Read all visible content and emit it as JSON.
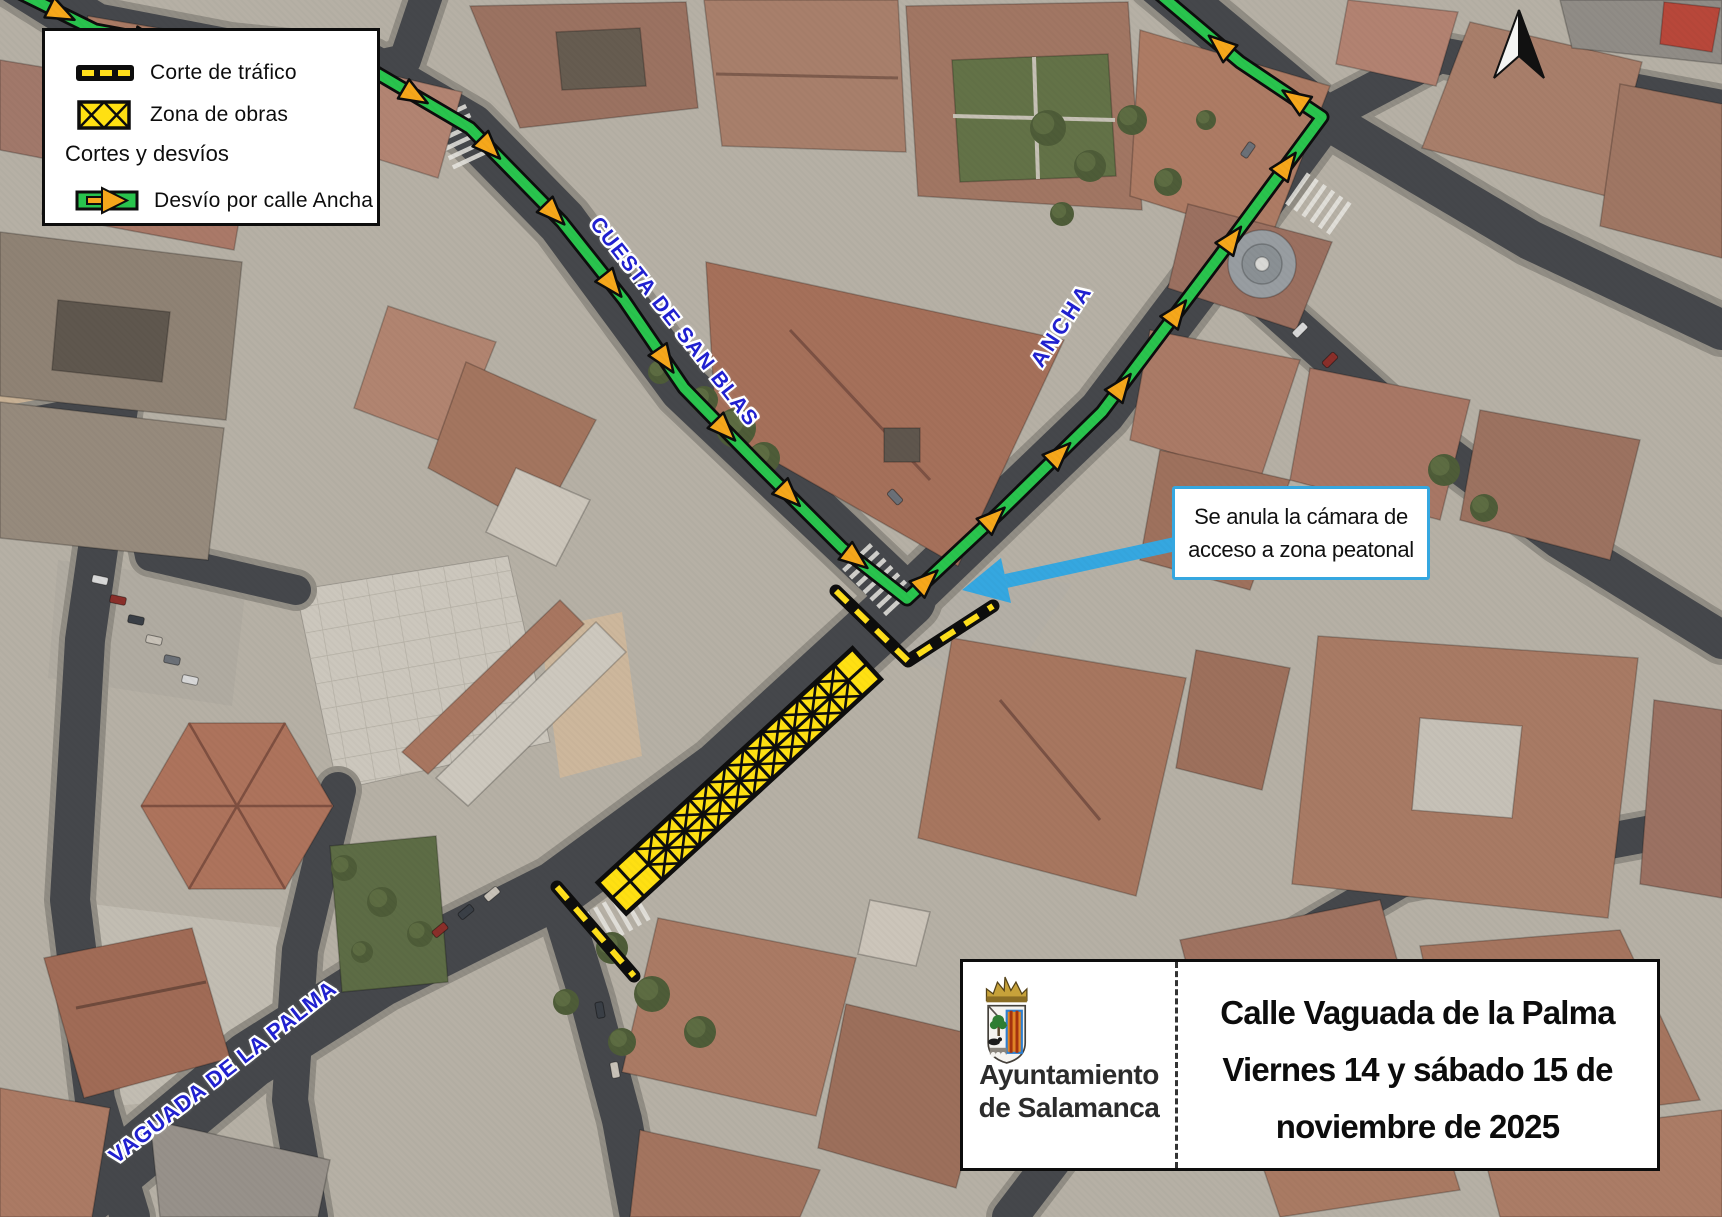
{
  "legend": {
    "items": [
      {
        "id": "corte-swatch",
        "label": "Corte de tráfico"
      },
      {
        "id": "obras-swatch",
        "label": "Zona de obras"
      }
    ],
    "section_header": "Cortes y desvíos",
    "detour": {
      "id": "desvio-swatch",
      "label": "Desvío por calle Ancha"
    }
  },
  "street_labels": {
    "san_blas": "CUESTA DE SAN BLAS",
    "ancha": "ANCHA",
    "vaguada": "VAGUADA DE LA PALMA"
  },
  "callout": {
    "line1": "Se anula la cámara de",
    "line2": "acceso a zona peatonal"
  },
  "title_box": {
    "org_line1": "Ayuntamiento",
    "org_line2": "de Salamanca",
    "line1": "Calle Vaguada de la Palma",
    "line2": "Viernes 14 y sábado 15 de",
    "line3": "noviembre de 2025"
  },
  "colors": {
    "route_green": "#29c44d",
    "arrow_orange": "#f6a71b",
    "dash_yellow": "#ffdf1b",
    "obras_yellow": "#ffe012",
    "street_label_blue": "#2020cf",
    "callout_blue": "#35a7e0"
  }
}
